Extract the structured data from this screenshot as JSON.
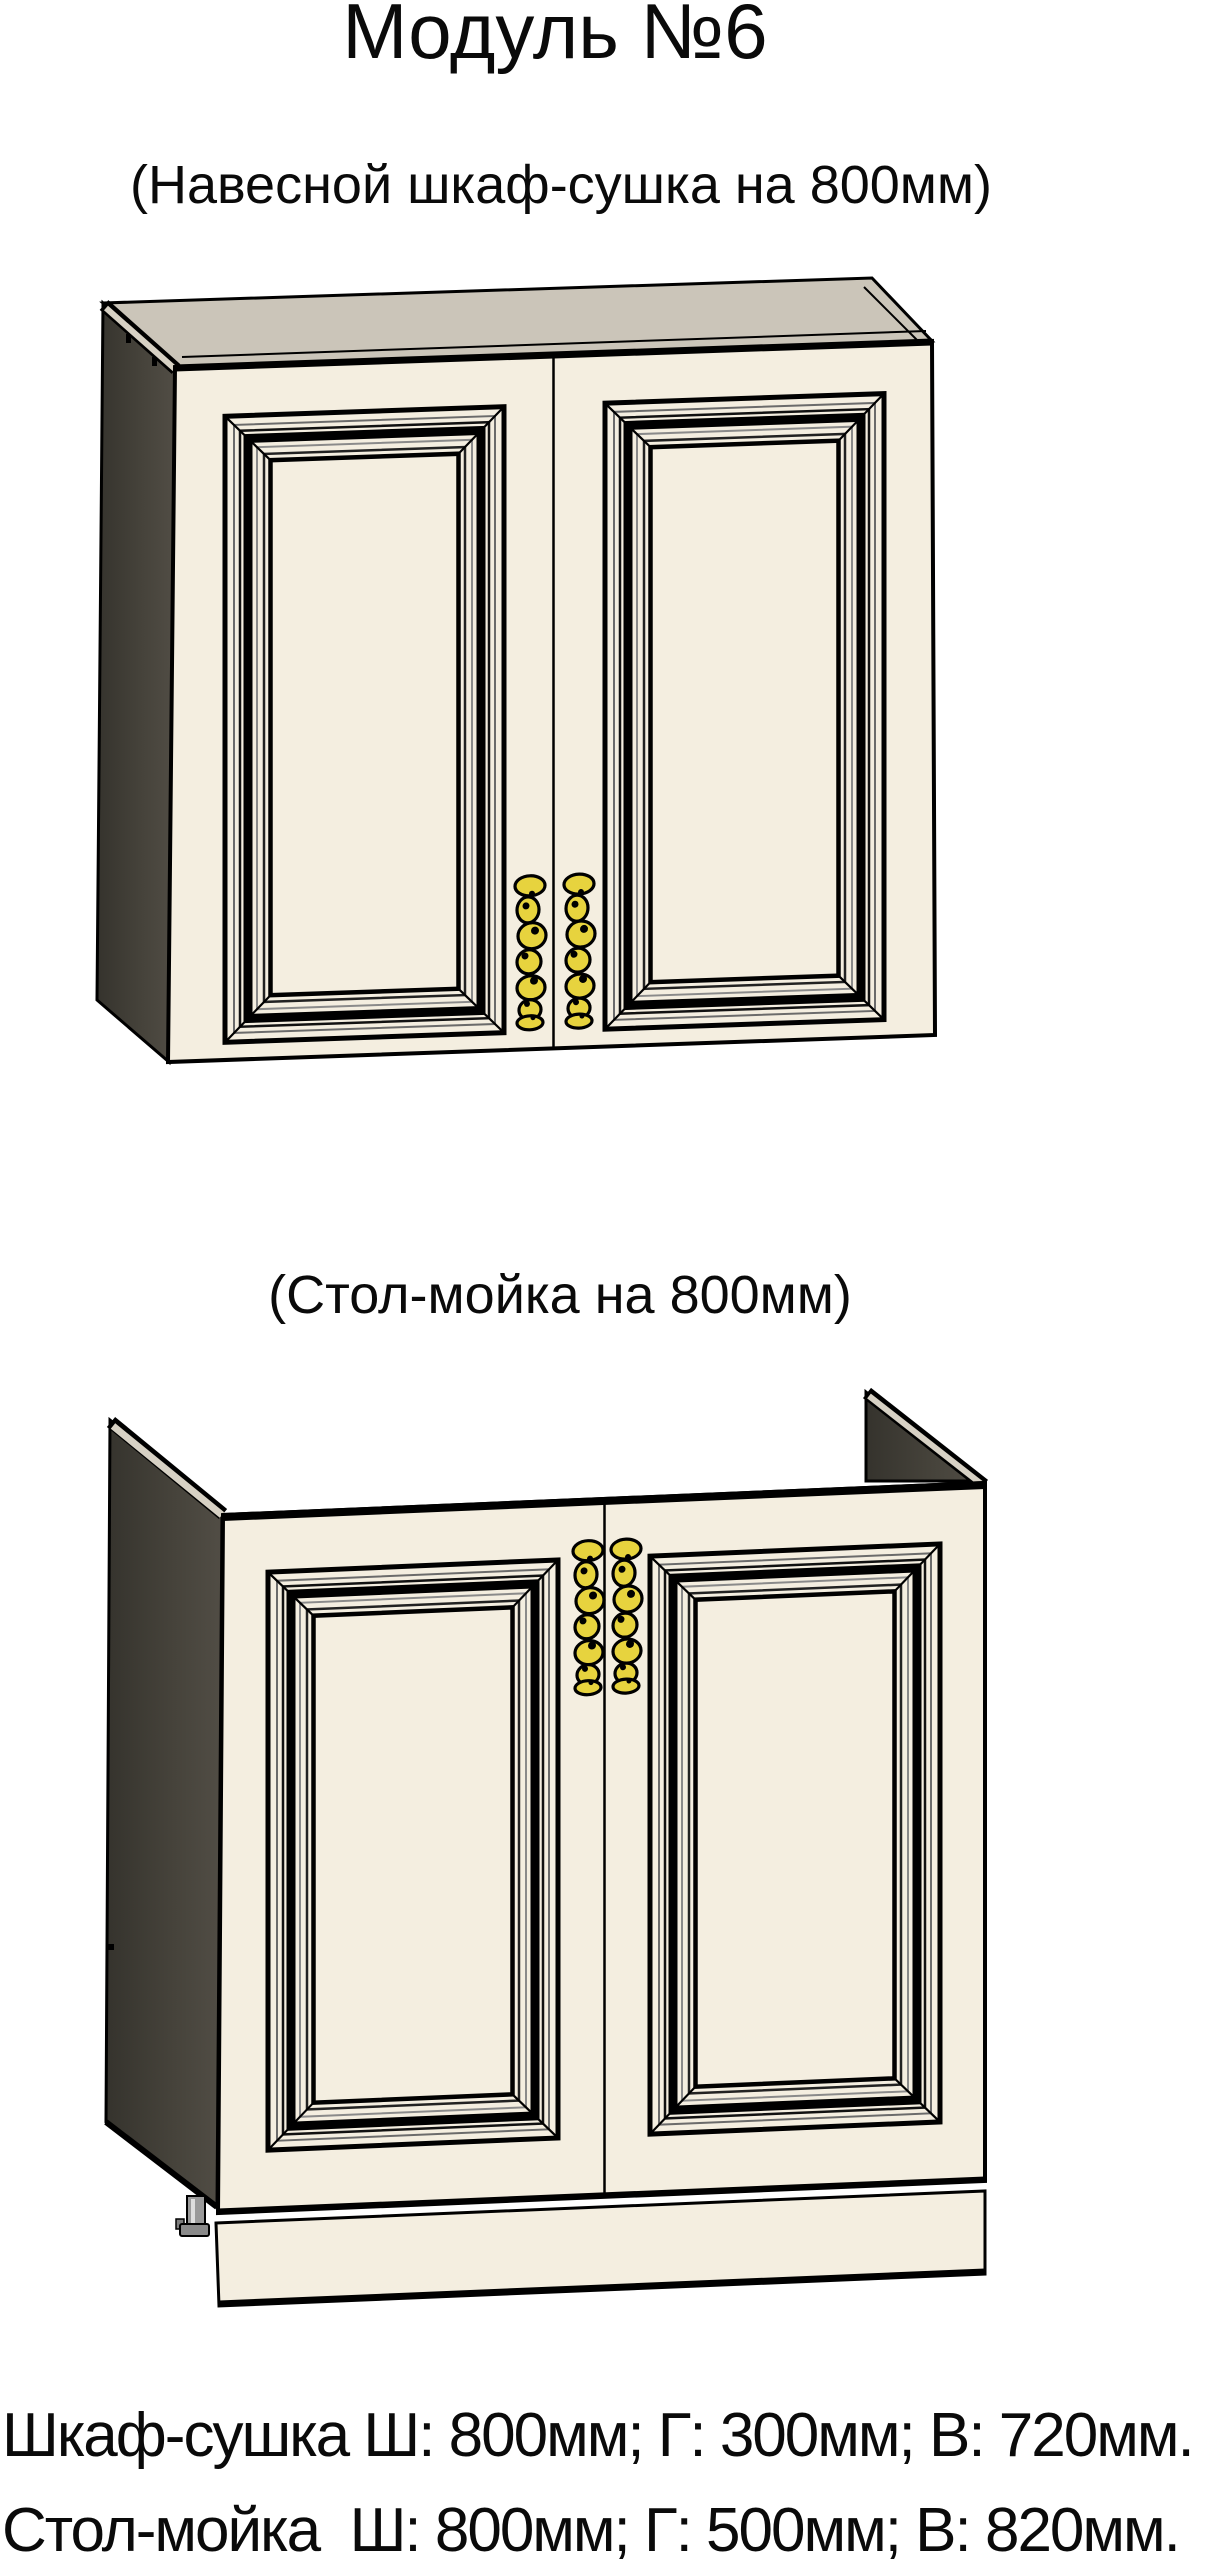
{
  "page": {
    "title": "Модуль №6",
    "kind": "furniture-module-spec-sheet"
  },
  "sections": [
    {
      "caption": "(Навесной шкаф-сушка на 800мм)",
      "drawing": "wall-dryer-cabinet",
      "description": "3D line drawing of a two-door wall cabinet with ornate door moldings and two gold handles at bottom center"
    },
    {
      "caption": "(Стол-мойка на 800мм)",
      "drawing": "sink-base-cabinet",
      "description": "3D line drawing of a two-door sink base cabinet with raised side panels, plinth, leveling leg and two gold handles at top center"
    }
  ],
  "specs": [
    "Шкаф-сушка Ш: 800мм; Г: 300мм; В: 720мм.",
    "Стол-мойка  Ш: 800мм; Г: 500мм; В: 820мм."
  ],
  "colors": {
    "front_panel": "#f4eee0",
    "top_face": "#cbc5b9",
    "side_panel_dark": "#44413a",
    "edge_band": "#d7d1c4",
    "handle_gold": "#e7d33e",
    "outline": "#000000",
    "background": "#ffffff"
  }
}
